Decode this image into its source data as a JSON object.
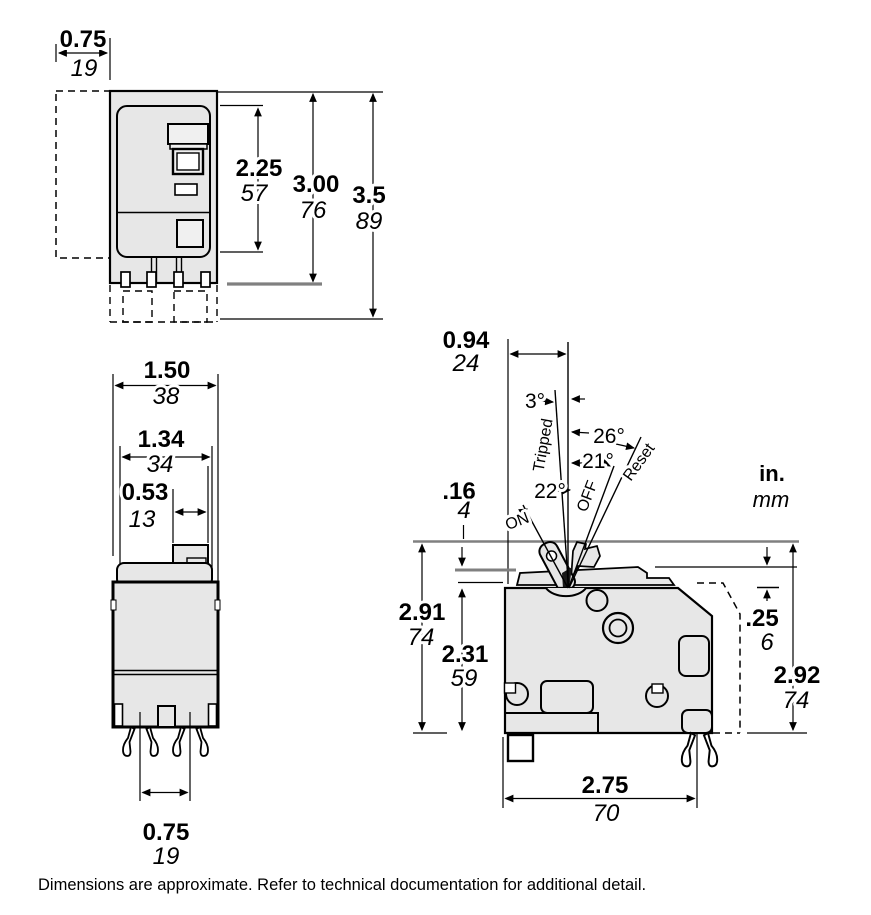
{
  "colors": {
    "body_fill": "#e7e7e7",
    "outline": "#000000",
    "dim_gray": "#808080",
    "background": "#ffffff"
  },
  "units": {
    "inches": "in.",
    "millimeters": "mm"
  },
  "caption": "Dimensions are approximate. Refer to technical documentation for additional detail.",
  "front_view": {
    "dims": {
      "side_clearance": {
        "in": "0.75",
        "mm": "19"
      },
      "face_height": {
        "in": "2.25",
        "mm": "57"
      },
      "body_height": {
        "in": "3.00",
        "mm": "76"
      },
      "overall_height": {
        "in": "3.5",
        "mm": "89"
      }
    }
  },
  "bottom_view": {
    "dims": {
      "overall_width": {
        "in": "1.50",
        "mm": "38"
      },
      "body_width": {
        "in": "1.34",
        "mm": "34"
      },
      "tab_width": {
        "in": "0.53",
        "mm": "13"
      },
      "clip_spacing": {
        "in": "0.75",
        "mm": "19"
      }
    }
  },
  "side_view": {
    "dims": {
      "handle_offset": {
        "in": "0.94",
        "mm": "24"
      },
      "cap_step": {
        "in": ".16",
        "mm": "4"
      },
      "height_to_handle": {
        "in": "2.91",
        "mm": "74"
      },
      "body_height": {
        "in": "2.31",
        "mm": "59"
      },
      "rear_step": {
        "in": ".25",
        "mm": "6"
      },
      "overall_height": {
        "in": "2.92",
        "mm": "74"
      },
      "depth": {
        "in": "2.75",
        "mm": "70"
      }
    },
    "angles": {
      "tripped": "3°",
      "reset": "26°",
      "off": "21°",
      "on": "22°"
    },
    "handle_positions": {
      "on": "ON",
      "off": "OFF",
      "tripped": "Tripped",
      "reset": "Reset"
    }
  }
}
